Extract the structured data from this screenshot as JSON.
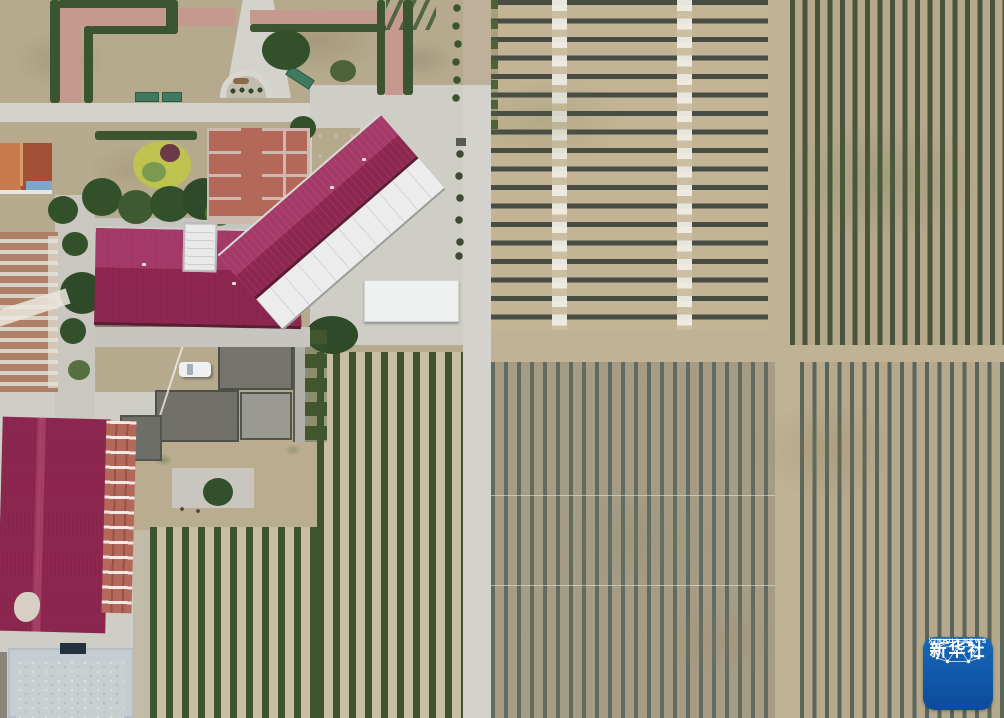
{
  "image_type": "aerial-photograph",
  "watermark": {
    "line1": "新华社",
    "line2": "XINHUA NEWS",
    "icon": "network-globe-icon",
    "shape": "rounded-square-badge"
  },
  "palette": {
    "soil": "#bfb199",
    "soil-dark": "#b9ac8f",
    "grass-dry": "#b6aa8e",
    "dirt": "#c0b295",
    "concrete": "#cecdc6",
    "road": "#d3d2cc",
    "roof": "#8e2750",
    "roof-lite": "#a53a68",
    "roof-white": "#ececec",
    "hedge": "#3a5530",
    "tree": "#32502a",
    "yellow-bush": "#bdc34e",
    "brick-path": "#c39a8d",
    "brick-red": "#b4685a",
    "court-bg": "#cdb9ae",
    "gh-tile": "#b08066",
    "gh-light": "#d8d2c6",
    "orange-roof": "#bc6342",
    "dark-roof": "#75756e",
    "blue-roof": "#c6cdd2",
    "field-soil": "#c3b495",
    "field-soil2": "#b5a88b",
    "field-gray": "#a89c82",
    "row-dark": "#474c44",
    "row-green": "#49543c",
    "row-blue": "#5c655a",
    "orchard-green": "#3e5330",
    "orchard-soil": "#cabea2",
    "wm-blue1": "#1668b8",
    "wm-blue2": "#0c4c9c"
  },
  "regions": [
    "ornamental-garden",
    "paved-courtyard",
    "main-building-crimson-roof",
    "white-lower-roof",
    "white-canopy",
    "greenhouse-rows",
    "orange-tile-building",
    "warehouse-crimson-roof",
    "brick-facade",
    "blue-roof-shed",
    "gray-flat-roofs",
    "white-car",
    "concrete-road-horizontal",
    "concrete-road-vertical",
    "plaza",
    "trellis-field-horizontal-rows",
    "orchard-field-vertical-rows",
    "seedling-field-left",
    "seedling-field-right",
    "orchard-block-bottom"
  ]
}
